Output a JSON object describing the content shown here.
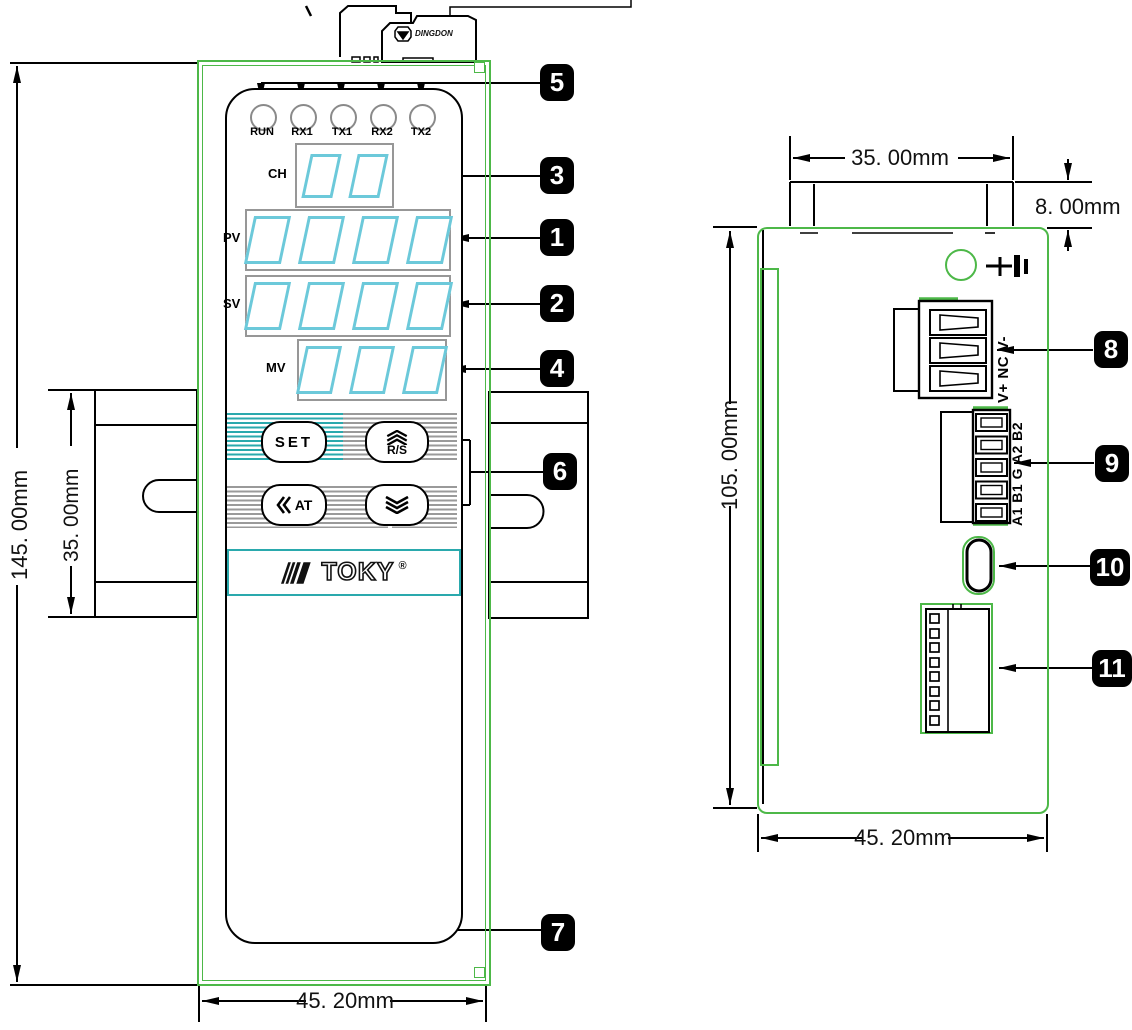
{
  "colors": {
    "outline_green": "#4db848",
    "accent_teal": "#2aa9ad",
    "digit_cyan": "#6cc9da",
    "callout_bg": "#000000"
  },
  "callouts": [
    "1",
    "2",
    "3",
    "4",
    "5",
    "6",
    "7",
    "8",
    "9",
    "10",
    "11"
  ],
  "front_view": {
    "led_labels": [
      "RUN",
      "RX1",
      "TX1",
      "RX2",
      "TX2"
    ],
    "display_labels": {
      "ch": "CH",
      "pv": "PV",
      "sv": "SV",
      "mv": "MV"
    },
    "button_labels": {
      "set": "SET",
      "run_stop": "R/S",
      "autotune": "AT"
    },
    "brand": "TOKY",
    "registered_mark": "®"
  },
  "top_connector": {
    "brand": "DINGDON"
  },
  "side_view": {
    "power_terminal_label": "V+ NC V-",
    "comm_terminal_label": "A1 B1 G A2 B2"
  },
  "dimensions": {
    "front_height": "145. 00mm",
    "din_rail_height": "35. 00mm",
    "front_width": "45. 20mm",
    "top_tab_width": "35. 00mm",
    "top_tab_height": "8. 00mm",
    "side_height": "105. 00mm",
    "side_width": "45. 20mm"
  }
}
